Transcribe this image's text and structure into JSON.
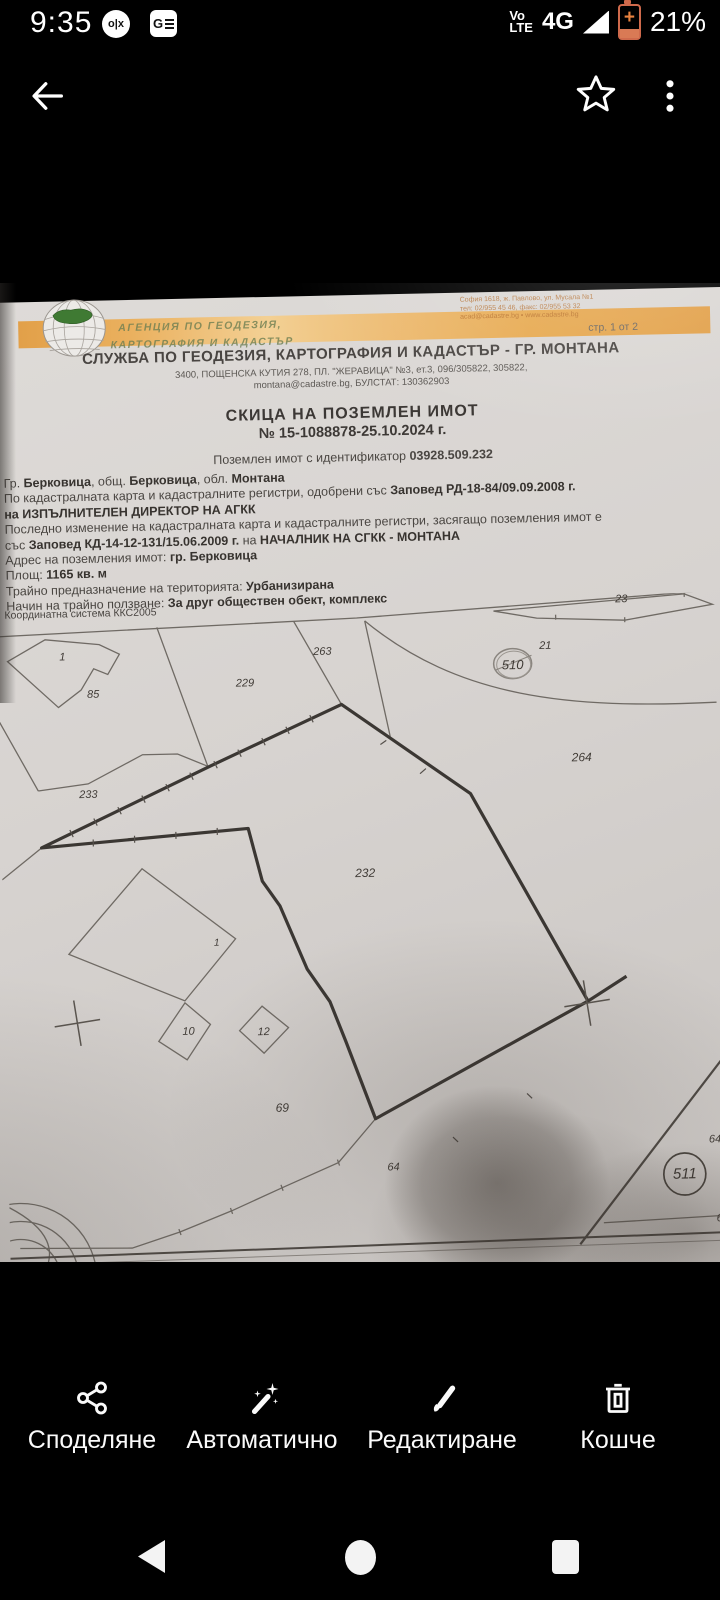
{
  "status_bar": {
    "time": "9:35",
    "olx_glyph": "o|x",
    "gnews_glyph": "G",
    "volte_top": "Vo",
    "volte_bottom": "LTE",
    "network": "4G",
    "battery_percent": "21%",
    "battery_color": "#cf6a4c"
  },
  "document": {
    "agency_line1": "АГЕНЦИЯ ПО ГЕОДЕЗИЯ,",
    "agency_line2": "КАРТОГРАФИЯ И КАДАСТЪР",
    "office_address_line1": "София 1618, ж. Павлово, ул. Мусала №1",
    "office_address_line2": "тел: 02/955 45 46, факс: 02/955 53 32",
    "office_address_line3": "acad@cadastre.bg • www.cadastre.bg",
    "page_indicator": "стр. 1 от 2",
    "office_title": "СЛУЖБА ПО ГЕОДЕЗИЯ, КАРТОГРАФИЯ И КАДАСТЪР - ГР. МОНТАНА",
    "office_subtitle1": "3400, ПОЩЕНСКА КУТИЯ 278, ПЛ. \"ЖЕРАВИЦА\" №3, ет.3, 096/305822, 305822,",
    "office_subtitle2": "montana@cadastre.bg, БУЛСТАТ: 130362903",
    "doc_title": "СКИЦА НА ПОЗЕМЛЕН ИМОТ",
    "doc_number": "№ 15-1088878-25.10.2024 г.",
    "identifier_line_prefix": "Поземлен имот с идентификатор ",
    "identifier_value": "03928.509.232",
    "body_lines": [
      {
        "parts": [
          {
            "t": "Гр. "
          },
          {
            "t": "Берковица",
            "b": 1
          },
          {
            "t": ", общ. "
          },
          {
            "t": "Берковица",
            "b": 1
          },
          {
            "t": ", обл. "
          },
          {
            "t": "Монтана",
            "b": 1
          }
        ]
      },
      {
        "parts": [
          {
            "t": "По кадастралната карта и кадастралните регистри, одобрени със "
          },
          {
            "t": "Заповед РД-18-84/09.09.2008 г.",
            "b": 1
          }
        ]
      },
      {
        "parts": [
          {
            "t": "на ИЗПЪЛНИТЕЛЕН ДИРЕКТОР НА АГКК",
            "b": 1
          }
        ]
      },
      {
        "parts": [
          {
            "t": "Последно изменение на кадастралната карта и кадастралните регистри, засягащо поземления имот е"
          }
        ]
      },
      {
        "parts": [
          {
            "t": "със "
          },
          {
            "t": "Заповед КД-14-12-131/15.06.2009 г.",
            "b": 1
          },
          {
            "t": " на "
          },
          {
            "t": "НАЧАЛНИК НА СГКК - МОНТАНА",
            "b": 1
          }
        ]
      },
      {
        "parts": [
          {
            "t": "Адрес на поземления имот: "
          },
          {
            "t": "гр. Берковица",
            "b": 1
          }
        ]
      },
      {
        "parts": [
          {
            "t": "Площ: "
          },
          {
            "t": "1165 кв. м",
            "b": 1
          }
        ]
      },
      {
        "parts": [
          {
            "t": "Трайно предназначение на територията: "
          },
          {
            "t": "Урбанизирана",
            "b": 1
          }
        ]
      },
      {
        "parts": [
          {
            "t": "Начин на трайно ползване: "
          },
          {
            "t": "За друг обществен обект, комплекс",
            "b": 1
          }
        ]
      }
    ],
    "coord_system": "Координатна система ККС2005",
    "map_labels": [
      {
        "t": "1",
        "x": 65,
        "y": 651,
        "fs": 11
      },
      {
        "t": "85",
        "x": 95,
        "y": 689,
        "fs": 11
      },
      {
        "t": "263",
        "x": 325,
        "y": 651,
        "fs": 11
      },
      {
        "t": "229",
        "x": 247,
        "y": 681,
        "fs": 11
      },
      {
        "t": "23",
        "x": 625,
        "y": 605,
        "fs": 11
      },
      {
        "t": "21",
        "x": 548,
        "y": 650,
        "fs": 11
      },
      {
        "t": "510",
        "x": 515,
        "y": 668,
        "fs": 13
      },
      {
        "t": "264",
        "x": 582,
        "y": 762,
        "fs": 12
      },
      {
        "t": "233",
        "x": 88,
        "y": 789,
        "fs": 11
      },
      {
        "t": "232",
        "x": 363,
        "y": 873,
        "fs": 12
      },
      {
        "t": "1",
        "x": 213,
        "y": 940,
        "fs": 10
      },
      {
        "t": "10",
        "x": 183,
        "y": 1028,
        "fs": 11
      },
      {
        "t": "12",
        "x": 258,
        "y": 1030,
        "fs": 11
      },
      {
        "t": "69",
        "x": 275,
        "y": 1106,
        "fs": 12
      },
      {
        "t": "64",
        "x": 385,
        "y": 1168,
        "fs": 11
      },
      {
        "t": "645",
        "x": 710,
        "y": 1147,
        "fs": 11
      },
      {
        "t": "511",
        "x": 676,
        "y": 1181,
        "fs": 15
      },
      {
        "t": "64",
        "x": 713,
        "y": 1226,
        "fs": 11
      }
    ]
  },
  "bottom_bar": {
    "actions": [
      {
        "name": "share",
        "label": "Споделяне"
      },
      {
        "name": "auto-enhance",
        "label": "Автоматично"
      },
      {
        "name": "edit",
        "label": "Редактиране"
      },
      {
        "name": "trash",
        "label": "Кошче"
      }
    ]
  }
}
